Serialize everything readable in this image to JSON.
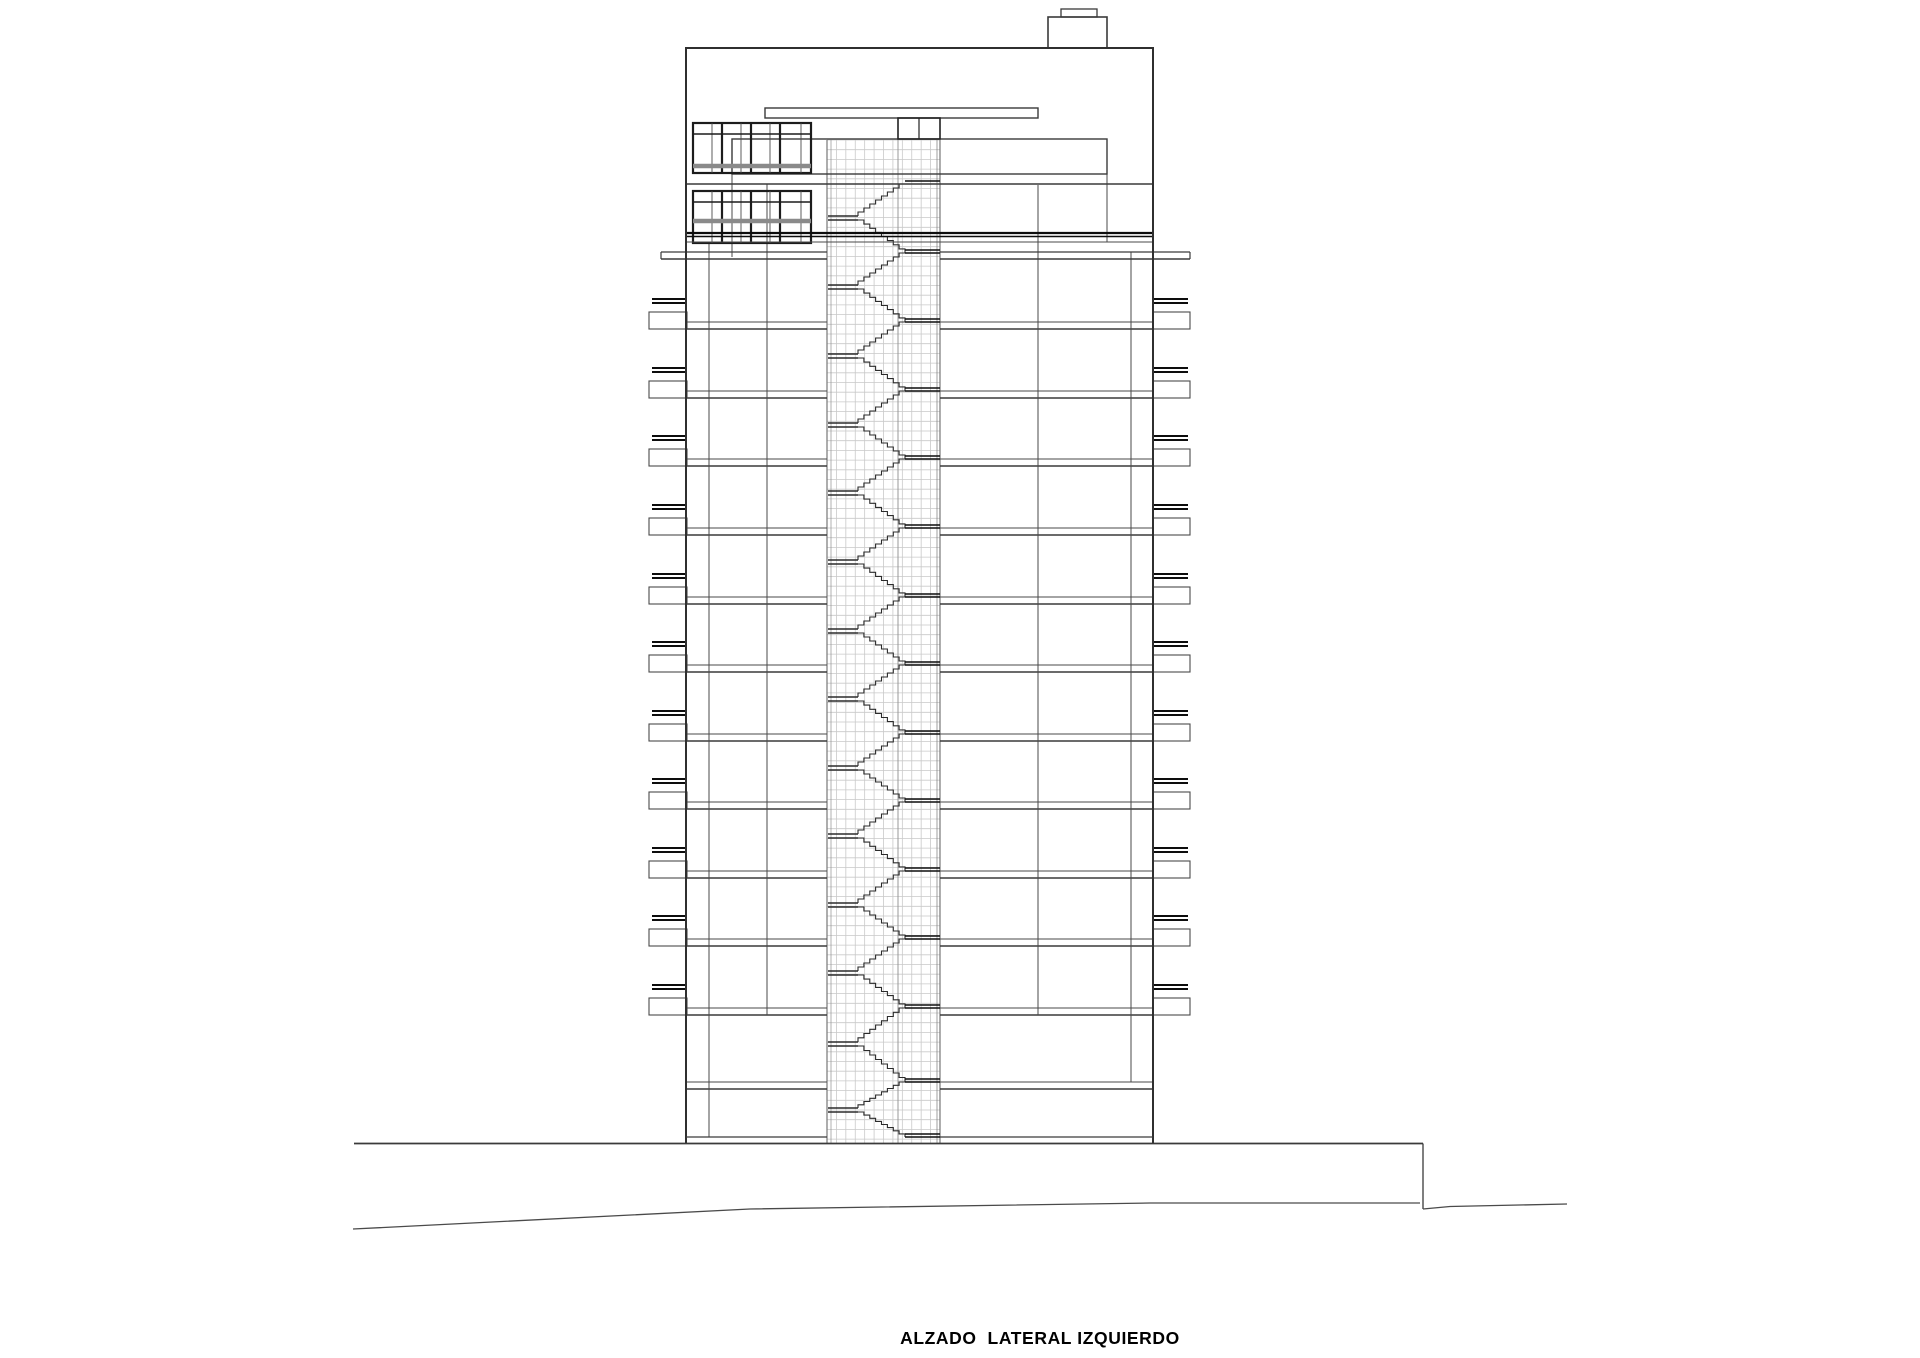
{
  "caption": {
    "text": "ALZADO  LATERAL IZQUIERDO"
  },
  "drawing": {
    "canvas": {
      "width": 1920,
      "height": 1358
    },
    "colors": {
      "line": "#3a3a3a",
      "dark": "#0d0d0d",
      "mid": "#4a4a4a",
      "light": "#777777",
      "grid": "#c9c9c9",
      "grid_accent": "#8f8f8f",
      "gray_band": "#8a8a8a",
      "background": "#ffffff"
    },
    "building": {
      "left": 686,
      "right": 1153,
      "top": 48,
      "base": 1143,
      "roof_box": {
        "x1": 1048,
        "y1": 17,
        "x2": 1107,
        "y2": 48
      },
      "roof_cap": {
        "x1": 1061,
        "y1": 9,
        "x2": 1097,
        "y2": 17
      },
      "canopy": {
        "x1": 765,
        "y1": 108,
        "x2": 1038,
        "y2": 118
      },
      "upper_window": {
        "x1": 693,
        "y1": 123,
        "x2": 811,
        "y2": 173,
        "transom_y": 134,
        "gray_y": 166,
        "mullions": [
          722,
          751,
          780
        ],
        "thin_offset": 19
      },
      "lower_window": {
        "x1": 693,
        "y1": 191,
        "x2": 811,
        "y2": 243,
        "transom_y": 202,
        "gray_y": 221,
        "mullions": [
          722,
          751,
          780
        ],
        "thin_offset": 19
      },
      "band": {
        "x1": 732,
        "y1": 139,
        "x2": 1107,
        "y2": 174
      },
      "small_window": {
        "x1": 898,
        "y1": 118,
        "x2": 940,
        "y2": 139,
        "mullion": 919
      },
      "division_y": 184,
      "heavy_band": {
        "y1": 233,
        "y2": 236.5,
        "thin_y": 242
      },
      "top_slab": {
        "x1": 661,
        "y1": 252,
        "x2": 1190,
        "y2": 259
      },
      "stair_strip": {
        "x1": 827,
        "x2": 940,
        "y1": 140,
        "y2": 1143,
        "cols": 12,
        "row_step": 9.7,
        "inner_wall_x": 898,
        "landing_x1": 828,
        "landing_x2": 858,
        "apex_x": 905
      },
      "mullions": [
        {
          "x": 709,
          "y1": 243,
          "y2": 1137
        },
        {
          "x": 767,
          "y1": 184,
          "y2": 1015
        },
        {
          "x": 732,
          "y1": 139,
          "y2": 257
        },
        {
          "x": 1038,
          "y1": 185,
          "y2": 1015
        },
        {
          "x": 1107,
          "y1": 139,
          "y2": 242
        },
        {
          "x": 1131,
          "y1": 252,
          "y2": 1082
        }
      ],
      "floor_slabs": [
        322,
        391,
        459,
        528,
        597,
        665,
        734,
        802,
        871,
        939,
        1008,
        1082,
        1137
      ],
      "balcony_floors": [
        322,
        391,
        459,
        528,
        597,
        665,
        734,
        802,
        871,
        939,
        1008
      ],
      "stair_landings": [
        184,
        253,
        322,
        391,
        459,
        528,
        597,
        665,
        734,
        802,
        871,
        939,
        1008,
        1082,
        1137
      ],
      "slab_thickness": 7,
      "balcony": {
        "left_box_x1": 649,
        "left_box_x2": 687,
        "right_box_x1": 1153,
        "right_box_x2": 1190,
        "box_top_offset": -10,
        "box_bottom_offset": 7,
        "rail_y_offsets": [
          -23,
          -19
        ],
        "rail_left": [
          652,
          687
        ],
        "rail_right": [
          1153,
          1188
        ]
      },
      "bottom_band_y": 1137
    },
    "ground": {
      "terrace": {
        "x1": 354,
        "x2": 1423,
        "y": 1143.5,
        "drop_bottom": 1209
      },
      "natural_left": [
        [
          353,
          1229
        ],
        [
          750,
          1209
        ],
        [
          1150,
          1203
        ],
        [
          1420,
          1203
        ]
      ],
      "natural_right": [
        [
          1423,
          1209
        ],
        [
          1450,
          1206.5
        ],
        [
          1567,
          1204
        ]
      ]
    }
  }
}
